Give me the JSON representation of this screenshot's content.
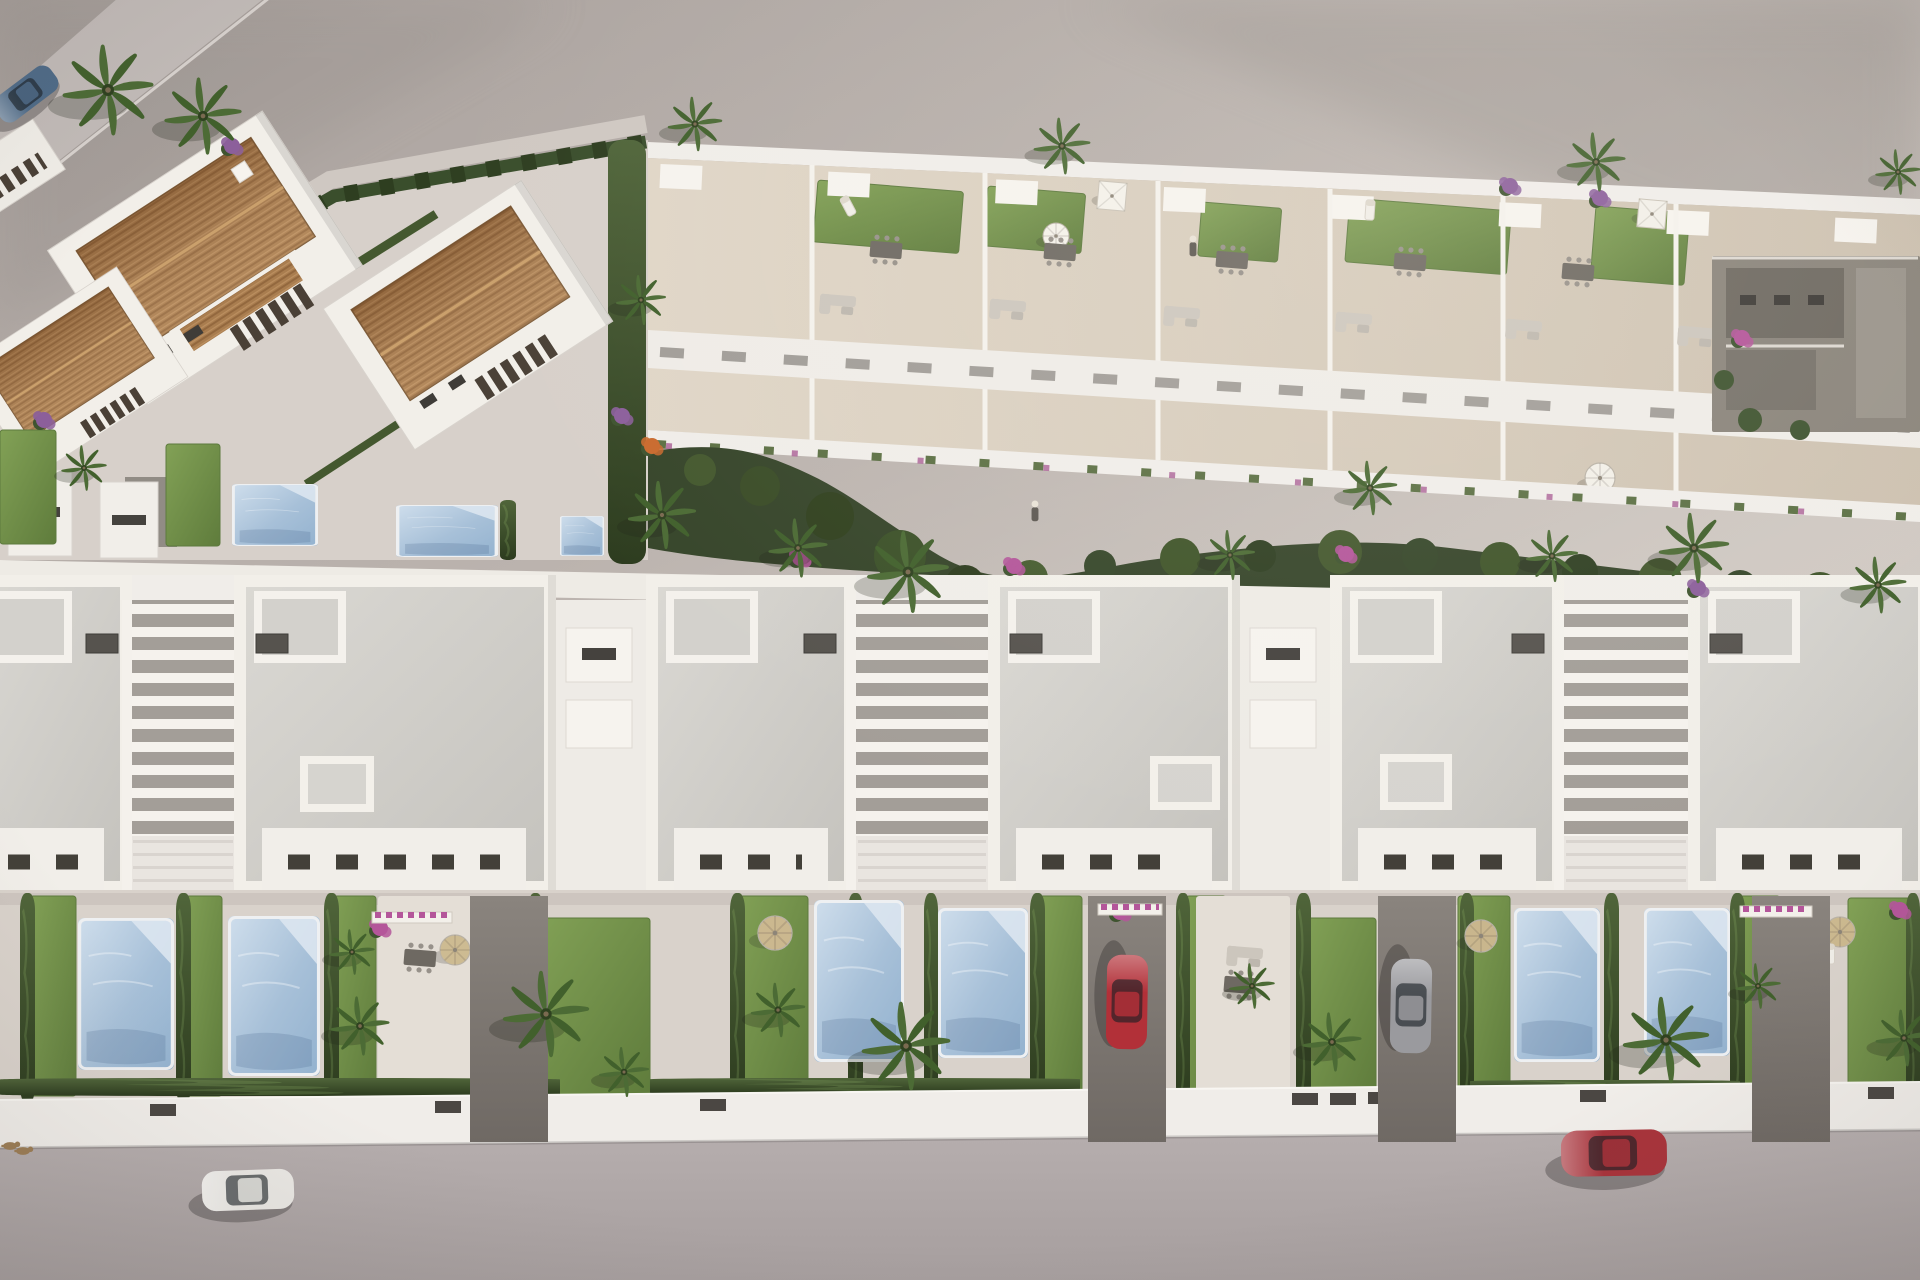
{
  "scene": {
    "description": "Aerial 3D architectural rendering of a Mediterranean residential development: a row of modern white villas with private pools and gardens in the foreground, a terraced block with rooftop lawns and parasols behind, terracotta-roofed houses at the upper left, palm trees, hedges, parked and driving cars on the bottom street",
    "style": "computer generated real-estate render, top-down oblique view, warm afternoon light"
  },
  "palette": {
    "ground_top": "#a8a09c",
    "ground_bottom": "#d6cfc9",
    "platform": "#d7d0ca",
    "road": "#b2aaaa",
    "wall_white": "#f0ede9",
    "building_white": "#f2efe9",
    "building_shadow": "#c9c4c0",
    "roof_gray": "#d2d0cb",
    "roof_terracotta": "#a97d4f",
    "terrace_beige": "#d8cec0",
    "garden_ground": "#d9d2cb",
    "lawn_green": "#78994e",
    "hedge_green": "#3e5230",
    "pool_blue": "#a7c0d8",
    "palm_green": "#4c6b35",
    "flower_purple": "#8c5f9b",
    "flower_magenta": "#b4569a",
    "flower_orange": "#c96a2e",
    "car_blue": "#4f6b88",
    "car_white": "#e9e7e3",
    "car_red": "#a8333b",
    "car_silver": "#9a9a9e"
  },
  "counts": {
    "foreground_villas": 6,
    "stair_courts": 3,
    "terracotta_houses": 4,
    "rooftop_terrace_units": 7,
    "swimming_pools": 9,
    "cars": 5,
    "palm_trees": 27,
    "people": 2,
    "dogs": 2
  },
  "objects": {
    "pools": [
      {
        "x": 78,
        "y": 918,
        "w": 96,
        "h": 152
      },
      {
        "x": 228,
        "y": 916,
        "w": 92,
        "h": 160
      },
      {
        "x": 814,
        "y": 900,
        "w": 90,
        "h": 162
      },
      {
        "x": 938,
        "y": 908,
        "w": 90,
        "h": 150
      },
      {
        "x": 1514,
        "y": 908,
        "w": 86,
        "h": 154
      },
      {
        "x": 1644,
        "y": 908,
        "w": 86,
        "h": 148
      },
      {
        "x": 232,
        "y": 484,
        "w": 86,
        "h": 62
      },
      {
        "x": 396,
        "y": 505,
        "w": 102,
        "h": 52
      },
      {
        "x": 560,
        "y": 516,
        "w": 44,
        "h": 40
      }
    ],
    "lawns": [
      {
        "x": 30,
        "y": 896,
        "w": 46,
        "h": 200
      },
      {
        "x": 182,
        "y": 896,
        "w": 40,
        "h": 200
      },
      {
        "x": 330,
        "y": 896,
        "w": 46,
        "h": 200
      },
      {
        "x": 534,
        "y": 918,
        "w": 116,
        "h": 178
      },
      {
        "x": 736,
        "y": 896,
        "w": 72,
        "h": 202
      },
      {
        "x": 1036,
        "y": 896,
        "w": 46,
        "h": 200
      },
      {
        "x": 1186,
        "y": 896,
        "w": 40,
        "h": 200
      },
      {
        "x": 1304,
        "y": 918,
        "w": 72,
        "h": 178
      },
      {
        "x": 1458,
        "y": 896,
        "w": 52,
        "h": 200
      },
      {
        "x": 1734,
        "y": 896,
        "w": 46,
        "h": 200
      },
      {
        "x": 1848,
        "y": 898,
        "w": 70,
        "h": 198
      },
      {
        "x": 0,
        "y": 430,
        "w": 56,
        "h": 114
      },
      {
        "x": 166,
        "y": 444,
        "w": 54,
        "h": 102
      }
    ],
    "terrace_lawns": [
      {
        "x": 818,
        "y": 180,
        "w": 146,
        "h": 62
      },
      {
        "x": 988,
        "y": 186,
        "w": 98,
        "h": 60
      },
      {
        "x": 1202,
        "y": 202,
        "w": 80,
        "h": 54
      },
      {
        "x": 1350,
        "y": 198,
        "w": 162,
        "h": 64
      },
      {
        "x": 1596,
        "y": 206,
        "w": 94,
        "h": 72
      }
    ],
    "hedges": [
      {
        "x": 20,
        "y": 893,
        "w": 15,
        "h": 210
      },
      {
        "x": 176,
        "y": 893,
        "w": 15,
        "h": 210
      },
      {
        "x": 324,
        "y": 893,
        "w": 15,
        "h": 210
      },
      {
        "x": 528,
        "y": 893,
        "w": 15,
        "h": 210
      },
      {
        "x": 730,
        "y": 893,
        "w": 15,
        "h": 210
      },
      {
        "x": 848,
        "y": 893,
        "w": 15,
        "h": 210
      },
      {
        "x": 924,
        "y": 893,
        "w": 14,
        "h": 210
      },
      {
        "x": 1030,
        "y": 893,
        "w": 15,
        "h": 210
      },
      {
        "x": 1176,
        "y": 893,
        "w": 14,
        "h": 210
      },
      {
        "x": 1296,
        "y": 893,
        "w": 15,
        "h": 210
      },
      {
        "x": 1460,
        "y": 893,
        "w": 14,
        "h": 210
      },
      {
        "x": 1604,
        "y": 893,
        "w": 15,
        "h": 210
      },
      {
        "x": 1730,
        "y": 893,
        "w": 15,
        "h": 210
      },
      {
        "x": 1906,
        "y": 893,
        "w": 14,
        "h": 210
      },
      {
        "x": 0,
        "y": 1078,
        "w": 560,
        "h": 18
      },
      {
        "x": 650,
        "y": 1078,
        "w": 430,
        "h": 16
      },
      {
        "x": 1470,
        "y": 1080,
        "w": 270,
        "h": 15
      },
      {
        "x": 500,
        "y": 500,
        "w": 16,
        "h": 60
      }
    ],
    "palms": [
      {
        "x": 108,
        "y": 90,
        "s": 2.0
      },
      {
        "x": 203,
        "y": 116,
        "s": 1.7
      },
      {
        "x": 695,
        "y": 124,
        "s": 1.2
      },
      {
        "x": 1062,
        "y": 146,
        "s": 1.25
      },
      {
        "x": 1596,
        "y": 162,
        "s": 1.3
      },
      {
        "x": 1898,
        "y": 172,
        "s": 1.0
      },
      {
        "x": 641,
        "y": 300,
        "s": 1.1
      },
      {
        "x": 84,
        "y": 468,
        "s": 1.0
      },
      {
        "x": 662,
        "y": 515,
        "s": 1.5
      },
      {
        "x": 798,
        "y": 548,
        "s": 1.3
      },
      {
        "x": 908,
        "y": 572,
        "s": 1.8
      },
      {
        "x": 1230,
        "y": 555,
        "s": 1.1
      },
      {
        "x": 1370,
        "y": 488,
        "s": 1.2
      },
      {
        "x": 1552,
        "y": 556,
        "s": 1.15
      },
      {
        "x": 1694,
        "y": 548,
        "s": 1.55
      },
      {
        "x": 1878,
        "y": 585,
        "s": 1.25
      },
      {
        "x": 352,
        "y": 952,
        "s": 1.0
      },
      {
        "x": 360,
        "y": 1026,
        "s": 1.3
      },
      {
        "x": 546,
        "y": 1014,
        "s": 1.9
      },
      {
        "x": 624,
        "y": 1072,
        "s": 1.1
      },
      {
        "x": 778,
        "y": 1010,
        "s": 1.2
      },
      {
        "x": 906,
        "y": 1046,
        "s": 1.95
      },
      {
        "x": 1252,
        "y": 986,
        "s": 1.0
      },
      {
        "x": 1332,
        "y": 1042,
        "s": 1.3
      },
      {
        "x": 1666,
        "y": 1040,
        "s": 1.9
      },
      {
        "x": 1758,
        "y": 986,
        "s": 1.0
      },
      {
        "x": 1904,
        "y": 1038,
        "s": 1.25
      }
    ],
    "cars": [
      {
        "name": "blue-van-top-left-road",
        "x": 26,
        "y": 94,
        "rot": -37,
        "s": 1.5,
        "c": "#4f6b88"
      },
      {
        "name": "white-car-street",
        "x": 248,
        "y": 1190,
        "rot": -2,
        "s": 2.0,
        "c": "#e9e7e3"
      },
      {
        "name": "red-car-street",
        "x": 1614,
        "y": 1153,
        "rot": -1,
        "s": 2.3,
        "c": "#a8333b"
      },
      {
        "name": "red-car-driveway",
        "x": 1127,
        "y": 1002,
        "rot": 91,
        "s": 2.05,
        "c": "#b23038"
      },
      {
        "name": "silver-car-driveway",
        "x": 1411,
        "y": 1006,
        "rot": 91,
        "s": 2.05,
        "c": "#9a9a9e"
      }
    ],
    "parasols": [
      {
        "x": 1112,
        "y": 196,
        "shape": "square",
        "c": "#f4f1ea",
        "rot": 5,
        "r": 13,
        "layer": "terrace"
      },
      {
        "x": 1652,
        "y": 214,
        "shape": "square",
        "c": "#f2efe8",
        "rot": 5,
        "r": 13,
        "layer": "terrace"
      },
      {
        "x": 1056,
        "y": 236,
        "shape": "round",
        "c": "#f4f1ea",
        "rot": 0,
        "r": 13,
        "layer": "terrace"
      },
      {
        "x": 1600,
        "y": 478,
        "shape": "round",
        "c": "#f2efe8",
        "rot": 0,
        "r": 15,
        "layer": "terrace"
      },
      {
        "x": 455,
        "y": 950,
        "shape": "round",
        "c": "#cdbb92",
        "rot": 0,
        "r": 15,
        "layer": "garden"
      },
      {
        "x": 775,
        "y": 933,
        "shape": "round",
        "c": "#cbb88f",
        "rot": 0,
        "r": 17,
        "layer": "garden"
      },
      {
        "x": 1481,
        "y": 936,
        "shape": "round",
        "c": "#c9b68d",
        "rot": 0,
        "r": 16,
        "layer": "garden"
      },
      {
        "x": 1840,
        "y": 932,
        "shape": "round",
        "c": "#cbb88f",
        "rot": 0,
        "r": 15,
        "layer": "garden"
      }
    ],
    "tables": [
      {
        "x": 886,
        "y": 250,
        "layer": "terrace"
      },
      {
        "x": 1060,
        "y": 252,
        "layer": "terrace"
      },
      {
        "x": 1232,
        "y": 260,
        "layer": "terrace"
      },
      {
        "x": 1410,
        "y": 262,
        "layer": "terrace"
      },
      {
        "x": 1578,
        "y": 272,
        "layer": "terrace"
      },
      {
        "x": 1748,
        "y": 278,
        "layer": "terrace"
      },
      {
        "x": 420,
        "y": 958,
        "layer": "garden"
      },
      {
        "x": 1240,
        "y": 985,
        "layer": "garden"
      }
    ],
    "sofas": [
      {
        "x": 838,
        "y": 300,
        "layer": "terrace"
      },
      {
        "x": 1008,
        "y": 305,
        "layer": "terrace"
      },
      {
        "x": 1182,
        "y": 312,
        "layer": "terrace"
      },
      {
        "x": 1354,
        "y": 318,
        "layer": "terrace"
      },
      {
        "x": 1524,
        "y": 325,
        "layer": "terrace"
      },
      {
        "x": 1696,
        "y": 332,
        "layer": "terrace"
      },
      {
        "x": 1245,
        "y": 952,
        "layer": "garden"
      }
    ],
    "loungers": [
      {
        "x": 848,
        "y": 206,
        "rot": -28,
        "layer": "terrace"
      },
      {
        "x": 1370,
        "y": 210,
        "rot": 4,
        "layer": "terrace"
      },
      {
        "x": 1440,
        "y": 906,
        "rot": 90,
        "layer": "garden"
      },
      {
        "x": 1830,
        "y": 954,
        "rot": 0,
        "layer": "garden"
      }
    ],
    "bushes": [
      {
        "x": 622,
        "y": 416,
        "c": "#8c5f9b"
      },
      {
        "x": 652,
        "y": 446,
        "c": "#c96a2e"
      },
      {
        "x": 800,
        "y": 558,
        "c": "#b4569a"
      },
      {
        "x": 1014,
        "y": 566,
        "c": "#b4569a"
      },
      {
        "x": 1346,
        "y": 554,
        "c": "#b4569a"
      },
      {
        "x": 1510,
        "y": 186,
        "c": "#8c5f9b"
      },
      {
        "x": 1600,
        "y": 198,
        "c": "#8c5f9b"
      },
      {
        "x": 1698,
        "y": 588,
        "c": "#8c5f9b"
      },
      {
        "x": 1742,
        "y": 338,
        "c": "#b4569a"
      },
      {
        "x": 44,
        "y": 420,
        "c": "#8c5f9b"
      },
      {
        "x": 232,
        "y": 146,
        "c": "#8c5f9b"
      },
      {
        "x": 380,
        "y": 928,
        "c": "#b4569a"
      },
      {
        "x": 1120,
        "y": 912,
        "c": "#b4569a"
      },
      {
        "x": 1900,
        "y": 910,
        "c": "#b4569a"
      }
    ],
    "flower_boxes": [
      {
        "x": 372,
        "y": 912,
        "w": 80
      },
      {
        "x": 1098,
        "y": 904,
        "w": 64
      },
      {
        "x": 1740,
        "y": 906,
        "w": 72
      }
    ],
    "gates": [
      {
        "x": 150,
        "y": 1104
      },
      {
        "x": 435,
        "y": 1101
      },
      {
        "x": 482,
        "y": 1101
      },
      {
        "x": 700,
        "y": 1099
      },
      {
        "x": 1292,
        "y": 1093
      },
      {
        "x": 1330,
        "y": 1093
      },
      {
        "x": 1368,
        "y": 1092
      },
      {
        "x": 1580,
        "y": 1090
      },
      {
        "x": 1868,
        "y": 1087
      }
    ],
    "figures": [
      {
        "x": 1035,
        "y": 512,
        "kind": "person"
      },
      {
        "x": 1193,
        "y": 247,
        "kind": "person"
      },
      {
        "x": 10,
        "y": 1146,
        "kind": "dog"
      },
      {
        "x": 23,
        "y": 1151,
        "kind": "dog"
      }
    ]
  }
}
